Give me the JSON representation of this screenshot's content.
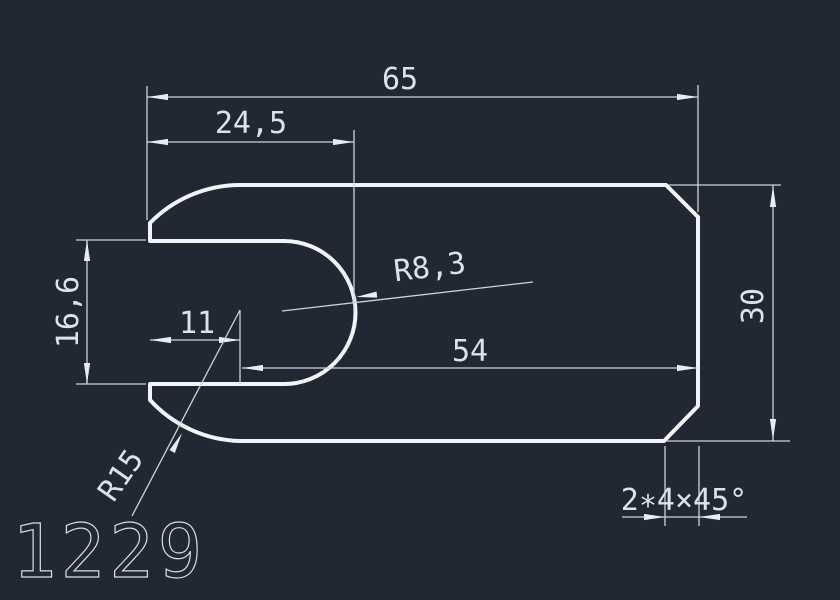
{
  "canvas": {
    "background_color": "#212733",
    "outline_color": "#f2f4f8",
    "dimension_line_color": "#cdd3dd",
    "text_color": "#dde2ea"
  },
  "drawing_number": "1229",
  "dimensions": {
    "total_length": {
      "label": "65"
    },
    "slot_depth": {
      "label": "24,5"
    },
    "slot_width": {
      "label": "16,6"
    },
    "arc_center_offset": {
      "label": "11"
    },
    "body_length": {
      "label": "54"
    },
    "total_height": {
      "label": "30"
    },
    "slot_end_radius": {
      "label": "R8,3"
    },
    "left_end_radius": {
      "label": "R15"
    },
    "chamfer_note": {
      "label": "2∗4×45°"
    }
  }
}
